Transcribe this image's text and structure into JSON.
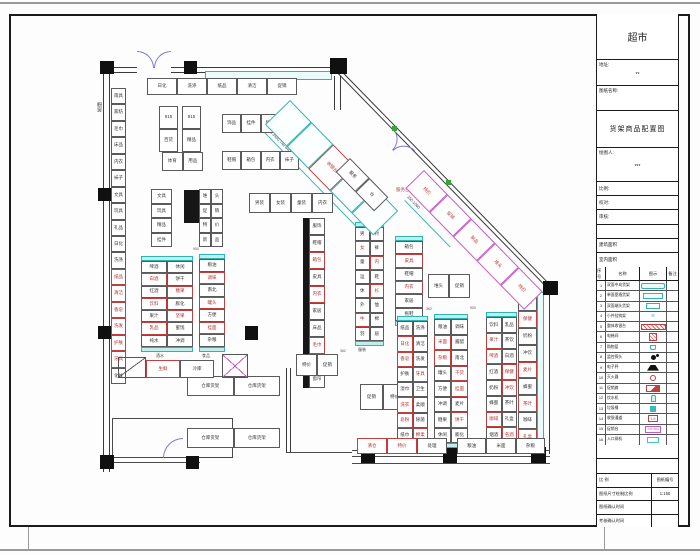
{
  "accent_colors": {
    "wall": "#3a3a3a",
    "cyan": "#2fb3b3",
    "red": "#c04040",
    "magenta": "#c55bc5",
    "door": "#7b7bd0",
    "green": "#3aa33a"
  },
  "title_block": {
    "store_title": "超市",
    "address_label": "地址:",
    "address_value": "**",
    "drawing_name_label": "图纸名称:",
    "drawing_name": "货架商品配置图",
    "drafter_label": "绘图人:",
    "drafter_value": "***",
    "fields": [
      {
        "label": "比例:"
      },
      {
        "label": "校对:"
      },
      {
        "label": "审核:"
      },
      {
        "label": ""
      },
      {
        "label": "建筑面积"
      },
      {
        "label": "室内面积"
      }
    ],
    "legend": {
      "headers": [
        "序号",
        "名称",
        "图示",
        "备注"
      ],
      "rows": [
        {
          "no": "1",
          "name": "双面中岛货架",
          "sym": "teal-roundrect",
          "glyph": ""
        },
        {
          "no": "2",
          "name": "单面靠墙货架",
          "sym": "teal-rect",
          "glyph": ""
        },
        {
          "no": "3",
          "name": "双面端头货架",
          "sym": "teal-rect-sm",
          "glyph": ""
        },
        {
          "no": "4",
          "name": "小件挂钩架",
          "sym": "teal-glyph",
          "glyph": "≋"
        },
        {
          "no": "5",
          "name": "整体收银台",
          "sym": "red-bar",
          "glyph": ""
        },
        {
          "no": "6",
          "name": "电梯间",
          "sym": "red-hatch",
          "glyph": ""
        },
        {
          "no": "7",
          "name": "购物篮",
          "sym": "teal-basket",
          "glyph": ""
        },
        {
          "no": "8",
          "name": "监控探头",
          "sym": "black-dot",
          "glyph": ""
        },
        {
          "no": "9",
          "name": "电子秤",
          "sym": "black-trap",
          "glyph": ""
        },
        {
          "no": "10",
          "name": "灭火器",
          "sym": "red-ring",
          "glyph": ""
        },
        {
          "no": "11",
          "name": "促销旗",
          "sym": "red-flag",
          "glyph": ""
        },
        {
          "no": "12",
          "name": "饮水机",
          "sym": "teal-bottle",
          "glyph": ""
        },
        {
          "no": "13",
          "name": "垃圾桶",
          "sym": "teal-fill",
          "glyph": ""
        },
        {
          "no": "14",
          "name": "收银通道",
          "sym": "red-box",
          "glyph": "1.5"
        },
        {
          "no": "15",
          "name": "促销台",
          "sym": "magenta-box",
          "glyph": "700×600"
        },
        {
          "no": "16",
          "name": "入口闸机",
          "sym": "cyan-box",
          "glyph": ""
        }
      ]
    },
    "footer_rows": [
      {
        "l": "比 例",
        "r": "图纸编号"
      },
      {
        "l": "图纸尺寸绘制比例",
        "r": "1:150"
      },
      {
        "l": "图纸确认时间",
        "r": ""
      },
      {
        "l": "考核确认时间",
        "r": ""
      }
    ]
  },
  "plan": {
    "walls": [
      {
        "k": "dh",
        "x": 103,
        "y": 67,
        "w": 34,
        "h": 6
      },
      {
        "k": "dh",
        "x": 171,
        "y": 67,
        "w": 169,
        "h": 6
      },
      {
        "k": "dv",
        "x": 103,
        "y": 73,
        "w": 7,
        "h": 399
      },
      {
        "k": "dh",
        "x": 341,
        "y": 70,
        "w": 303,
        "h": 5,
        "rot": 45.7
      },
      {
        "k": "dv",
        "x": 543,
        "y": 288,
        "w": 7,
        "h": 166
      },
      {
        "k": "dv",
        "x": 334,
        "y": 76,
        "w": 7,
        "h": 34
      },
      {
        "k": "l",
        "x": 352,
        "y": 450,
        "w": 198,
        "h": 1
      },
      {
        "k": "l",
        "x": 352,
        "y": 456,
        "w": 198,
        "h": 1
      },
      {
        "k": "l",
        "x": 352,
        "y": 463,
        "w": 198,
        "h": 1
      },
      {
        "k": "l",
        "x": 107,
        "y": 457,
        "w": 93,
        "h": 1
      },
      {
        "k": "l",
        "x": 107,
        "y": 462,
        "w": 93,
        "h": 1
      },
      {
        "k": "dv",
        "x": 286,
        "y": 368,
        "w": 5,
        "h": 84
      },
      {
        "k": "l",
        "x": 286,
        "y": 452,
        "w": 66,
        "h": 1
      },
      {
        "k": "l",
        "x": 112,
        "y": 418,
        "w": 120,
        "h": 1
      },
      {
        "k": "l",
        "x": 112,
        "y": 418,
        "w": 1,
        "h": 40
      },
      {
        "k": "l",
        "x": 232,
        "y": 418,
        "w": 1,
        "h": 40
      },
      {
        "k": "l",
        "x": 112,
        "y": 457,
        "w": 120,
        "h": 1
      }
    ],
    "columns": [
      {
        "x": 100,
        "y": 61,
        "w": 14,
        "h": 13
      },
      {
        "x": 184,
        "y": 61,
        "w": 13,
        "h": 13
      },
      {
        "x": 330,
        "y": 58,
        "w": 17,
        "h": 16
      },
      {
        "x": 543,
        "y": 281,
        "w": 15,
        "h": 14
      },
      {
        "x": 98,
        "y": 188,
        "w": 14,
        "h": 13
      },
      {
        "x": 98,
        "y": 326,
        "w": 14,
        "h": 13
      },
      {
        "x": 100,
        "y": 455,
        "w": 14,
        "h": 14
      },
      {
        "x": 186,
        "y": 456,
        "w": 13,
        "h": 13
      },
      {
        "x": 361,
        "y": 447,
        "w": 14,
        "h": 16
      },
      {
        "x": 443,
        "y": 447,
        "w": 14,
        "h": 16
      },
      {
        "x": 531,
        "y": 447,
        "w": 15,
        "h": 16
      },
      {
        "x": 366,
        "y": 330,
        "w": 13,
        "h": 14
      },
      {
        "x": 245,
        "y": 326,
        "w": 13,
        "h": 14
      },
      {
        "x": 440,
        "y": 192,
        "w": 20,
        "h": 19,
        "rot": 45
      }
    ],
    "bars": [
      {
        "x": 303,
        "y": 218,
        "w": 6,
        "h": 170
      },
      {
        "x": 445,
        "y": 335,
        "w": 6,
        "h": 92
      },
      {
        "x": 184,
        "y": 190,
        "w": 15,
        "h": 33
      },
      {
        "x": 366,
        "y": 190,
        "w": 14,
        "h": 33
      }
    ],
    "cyan": [
      {
        "x": 205,
        "y": 71,
        "w": 127,
        "h": 9
      },
      {
        "x": 537,
        "y": 292,
        "w": 7,
        "h": 158
      }
    ],
    "doors": [
      {
        "x": 137,
        "y": 51,
        "s": 17,
        "o": "ne"
      },
      {
        "x": 154,
        "y": 51,
        "s": 17,
        "o": "nw"
      },
      {
        "x": 393,
        "y": 128,
        "s": 16,
        "o": "ne",
        "rot": 45.7
      },
      {
        "x": 404,
        "y": 139,
        "s": 16,
        "o": "nw",
        "rot": 45.7
      },
      {
        "x": 163,
        "y": 438,
        "s": 20,
        "o": "nw"
      }
    ],
    "greensq": [
      {
        "x": 392,
        "y": 126,
        "w": 5,
        "h": 5
      },
      {
        "x": 446,
        "y": 180,
        "w": 5,
        "h": 5
      }
    ],
    "dims": [
      {
        "x": 255,
        "y": 122,
        "w": 185,
        "rot": 45.7
      },
      {
        "x": 405,
        "y": 200,
        "w": 65,
        "rot": 45.7
      }
    ],
    "texts": [
      {
        "t": "橱窗",
        "x": 96,
        "y": 102,
        "s": 5,
        "c": "#444",
        "v": true
      },
      {
        "t": "690 640 740 3450 740 640 690",
        "x": 258,
        "y": 116,
        "s": 4,
        "c": "#333",
        "rot": 45.7
      },
      {
        "t": "150 1060",
        "x": 409,
        "y": 195,
        "s": 4,
        "c": "#333",
        "rot": 45.7
      },
      {
        "t": "服务台",
        "x": 396,
        "y": 188,
        "s": 4.5,
        "c": "#c04040"
      },
      {
        "t": "酒水",
        "x": 156,
        "y": 354,
        "s": 4,
        "c": "#444"
      },
      {
        "t": "食品",
        "x": 202,
        "y": 354,
        "s": 4,
        "c": "#444"
      },
      {
        "t": "服装",
        "x": 358,
        "y": 348,
        "s": 4,
        "c": "#444"
      },
      {
        "t": "900",
        "x": 193,
        "y": 248,
        "s": 3.5,
        "c": "#555"
      },
      {
        "t": "900",
        "x": 385,
        "y": 215,
        "s": 3.5,
        "c": "#555"
      },
      {
        "t": "362",
        "x": 426,
        "y": 308,
        "s": 3.5,
        "c": "#555"
      },
      {
        "t": "900",
        "x": 470,
        "y": 307,
        "s": 3.5,
        "c": "#555"
      },
      {
        "t": "362",
        "x": 340,
        "y": 350,
        "s": 3.5,
        "c": "#555"
      }
    ],
    "groups": [
      {
        "name": "top-wall-shelf-row",
        "x": 147,
        "y": 78,
        "w": 150,
        "h": 17,
        "cols": 5,
        "cells": [
          "日化",
          "洗涤",
          "纸品",
          "清洁",
          "促销"
        ]
      },
      {
        "name": "shelf-915-a",
        "x": 159,
        "y": 106,
        "w": 19,
        "h": 46,
        "cols": 1,
        "cells": [
          "915",
          "百货"
        ]
      },
      {
        "name": "shelf-915-b",
        "x": 182,
        "y": 106,
        "w": 19,
        "h": 46,
        "cols": 1,
        "cells": [
          "915",
          "精品"
        ]
      },
      {
        "name": "sports-shelf",
        "x": 162,
        "y": 152,
        "w": 41,
        "h": 19,
        "cols": 2,
        "cells": [
          "体育",
          "用品"
        ]
      },
      {
        "name": "small-row-1",
        "x": 222,
        "y": 114,
        "w": 58,
        "h": 19,
        "cols": 3,
        "cells": [
          "饰品",
          "挂件",
          "精品"
        ]
      },
      {
        "name": "small-row-2",
        "x": 222,
        "y": 151,
        "w": 77,
        "h": 19,
        "cols": 4,
        "cells": [
          "鞋帽",
          "箱包",
          "内衣",
          "袜子"
        ]
      },
      {
        "name": "left-wall-shelf",
        "x": 111,
        "y": 88,
        "w": 15,
        "h": 296,
        "cols": 1,
        "cells": [
          "雨具",
          "家纺",
          "毛巾",
          "床品",
          "内衣",
          "袜子",
          "文具",
          "玩具",
          "礼品",
          "日化",
          "洗涤",
          "纸品r",
          "清洁r",
          "香皂r",
          "洗发r",
          "护肤r",
          "牙具r",
          "化妆"
        ]
      },
      {
        "name": "stack-d",
        "x": 151,
        "y": 189,
        "w": 21,
        "h": 58,
        "cols": 1,
        "cells": [
          "文具",
          "玩具",
          "精品",
          "挂件"
        ]
      },
      {
        "name": "grid-e",
        "x": 199,
        "y": 189,
        "w": 24,
        "h": 58,
        "cols": 2,
        "cells": [
          "堆",
          "头",
          "促",
          "销",
          "特",
          "价",
          "新",
          "品"
        ]
      },
      {
        "name": "gondola-1",
        "x": 141,
        "y": 256,
        "w": 52,
        "h": 96,
        "cols": 2,
        "caps": true,
        "cells": [
          "啤酒",
          "休闲",
          "白酒r",
          "饼干",
          "红酒",
          "糖果r",
          "饮料r",
          "膨化",
          "果汁",
          "坚果r",
          "乳品r",
          "蜜饯",
          "纯水",
          "冲调"
        ]
      },
      {
        "name": "gondola-2",
        "x": 199,
        "y": 254,
        "w": 26,
        "h": 98,
        "cols": 1,
        "caps": true,
        "cells": [
          "粮油",
          "调味r",
          "南北",
          "罐头r",
          "方便",
          "挂面r",
          "杂粮"
        ]
      },
      {
        "name": "center-top-row",
        "x": 249,
        "y": 193,
        "w": 84,
        "h": 20,
        "cols": 4,
        "cells": [
          "男装",
          "女装",
          "童装",
          "内衣"
        ]
      },
      {
        "name": "center-run",
        "x": 309,
        "y": 218,
        "w": 16,
        "h": 170,
        "cols": 1,
        "cells": [
          "服饰",
          "鞋帽",
          "箱包r",
          "皮具",
          "内衣r",
          "家居",
          "床品",
          "毛巾r",
          "家纺",
          "窗帘"
        ]
      },
      {
        "name": "gondola-3",
        "x": 355,
        "y": 222,
        "w": 29,
        "h": 124,
        "cols": 2,
        "caps": true,
        "cells": [
          "男",
          "衬",
          "女r",
          "裤",
          "童",
          "内r",
          "运",
          "鞋",
          "休",
          "衫r",
          "外",
          "恤",
          "牛r",
          "棉",
          "羽",
          "居"
        ]
      },
      {
        "name": "gondola-4",
        "x": 395,
        "y": 236,
        "w": 28,
        "h": 90,
        "cols": 1,
        "caps": true,
        "cells": [
          "箱包",
          "皮具r",
          "鞋帽",
          "内衣r",
          "家居",
          "拖鞋"
        ]
      },
      {
        "name": "promo-a",
        "x": 428,
        "y": 274,
        "w": 42,
        "h": 24,
        "cols": 2,
        "cells": [
          "堆头",
          "促销"
        ]
      },
      {
        "name": "promo-b",
        "x": 296,
        "y": 354,
        "w": 42,
        "h": 22,
        "cols": 2,
        "cells": [
          "特价",
          "促销"
        ]
      },
      {
        "name": "promo-c",
        "x": 360,
        "y": 384,
        "w": 46,
        "h": 26,
        "cols": 2,
        "cells": [
          "促销",
          "特价"
        ]
      },
      {
        "name": "gondola-5",
        "x": 397,
        "y": 316,
        "w": 31,
        "h": 132,
        "cols": 2,
        "caps": true,
        "cells": [
          "纸品",
          "洗涤",
          "日化r",
          "清洁",
          "香皂r",
          "洗发",
          "护肤",
          "牙具r",
          "湿巾",
          "卫生",
          "洗衣r",
          "柔顺",
          "皂粉r",
          "除菌",
          "纸巾",
          "棉柔r"
        ]
      },
      {
        "name": "gondola-6",
        "x": 434,
        "y": 314,
        "w": 34,
        "h": 134,
        "cols": 2,
        "caps": true,
        "cells": [
          "粮油",
          "调味",
          "米面r",
          "酱醋",
          "杂粮r",
          "南北",
          "罐头",
          "干货r",
          "方便",
          "挂面r",
          "冲调",
          "麦片",
          "糖果",
          "饼干r",
          "休闲",
          "膨化"
        ]
      },
      {
        "name": "gondola-7",
        "x": 486,
        "y": 312,
        "w": 31,
        "h": 136,
        "cols": 2,
        "caps": true,
        "cells": [
          "饮料",
          "乳品",
          "果汁r",
          "茶饮",
          "啤酒r",
          "白酒",
          "红酒",
          "保健r",
          "奶粉",
          "冲饮r",
          "蜂蜜",
          "茶叶",
          "咖啡r",
          "礼盒",
          "烟酒",
          "名酒r"
        ]
      },
      {
        "name": "right-wall-shelf",
        "x": 518,
        "y": 294,
        "w": 19,
        "h": 152,
        "cols": 1,
        "cells": [
          "烟酒",
          "保健r",
          "奶粉",
          "冲饮",
          "麦片r",
          "蜂蜜",
          "茶叶r",
          "咖啡",
          "礼盒r"
        ]
      },
      {
        "name": "bottom-row-a",
        "x": 357,
        "y": 438,
        "w": 90,
        "h": 16,
        "cols": 3,
        "cells": [
          "清仓r",
          "特价r",
          "处理"
        ]
      },
      {
        "name": "bottom-row-b",
        "x": 457,
        "y": 438,
        "w": 88,
        "h": 16,
        "cols": 3,
        "cells": [
          "粮油",
          "米面",
          "杂粮"
        ]
      },
      {
        "name": "storage-row-1",
        "x": 187,
        "y": 376,
        "w": 93,
        "h": 20,
        "cols": 2,
        "cells": [
          "仓库货架",
          "仓库货架"
        ]
      },
      {
        "name": "storage-row-2",
        "x": 187,
        "y": 428,
        "w": 93,
        "h": 20,
        "cols": 2,
        "cells": [
          "仓库货架",
          "仓库货架"
        ]
      },
      {
        "name": "fresh-cells",
        "x": 146,
        "y": 360,
        "w": 68,
        "h": 18,
        "cols": 2,
        "cells": [
          "生鲜r",
          "冷库"
        ]
      },
      {
        "name": "corner-box",
        "x": 118,
        "y": 357,
        "w": 28,
        "h": 21,
        "type": "tri",
        "cells": []
      },
      {
        "name": "lift-box",
        "x": 222,
        "y": 354,
        "w": 26,
        "h": 24,
        "type": "xbox",
        "cells": []
      },
      {
        "name": "checkout-strip",
        "x": 290,
        "y": 100,
        "w": 155,
        "h": 35,
        "cols": 5,
        "rot": 45.7,
        "cls": "cyang",
        "cells": [
          "",
          "",
          "收银台",
          "",
          ""
        ]
      },
      {
        "name": "diag-promo-strip",
        "x": 424,
        "y": 170,
        "w": 170,
        "h": 26,
        "cols": 5,
        "rot": 45.7,
        "cls": "mag",
        "cells": [
          "特价",
          "促销",
          "新品",
          "堆头",
          "特价"
        ]
      },
      {
        "name": "service-counter",
        "x": 350,
        "y": 158,
        "w": 55,
        "h": 20,
        "cols": 2,
        "rot": 45.7,
        "cells": [
          "服务",
          "台"
        ]
      }
    ]
  }
}
